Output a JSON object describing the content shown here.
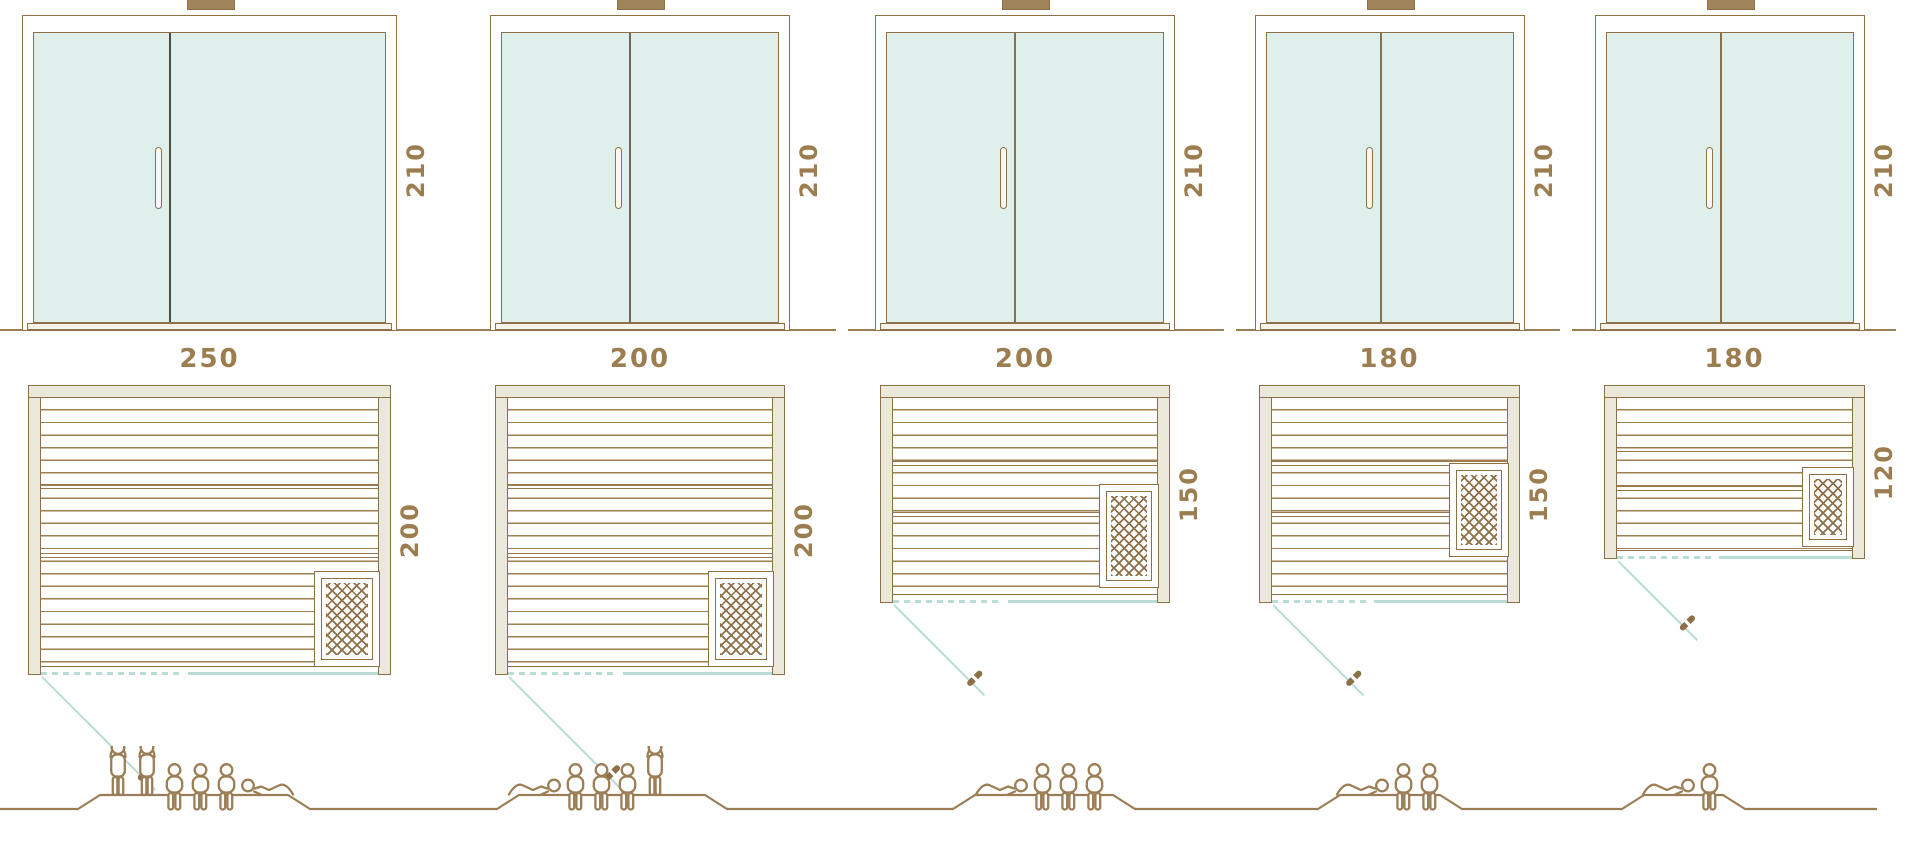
{
  "diagram": {
    "kind": "sauna-size-comparison",
    "rows": [
      "front-elevations",
      "floor-plans",
      "capacity-pictograms"
    ],
    "colors": {
      "line_brown": "#8e7048",
      "text_brown": "#9c7d50",
      "frame_beige": "#eae9d9",
      "glass_teal_fill": "#dff0ec",
      "teal_line": "#b9dcd6",
      "ground_brown": "#9a7d55",
      "background": "#ffffff"
    }
  },
  "units": [
    {
      "name": "sauna-250x200",
      "elevation": {
        "height_label": "210",
        "parts": [
          "glass-front",
          "door-divider",
          "door-handle",
          "top-cap",
          "base-sill"
        ]
      },
      "plan": {
        "width_label": "250",
        "depth_label": "200",
        "heater_position": "bottom-right",
        "door": "front-left, outward swing"
      },
      "capacity": {
        "standing": 2,
        "seated": 3,
        "lying": 1,
        "lying_position": "right",
        "total": 6
      }
    },
    {
      "name": "sauna-200x200",
      "elevation": {
        "height_label": "210",
        "parts": [
          "glass-front",
          "door-divider",
          "door-handle",
          "top-cap",
          "base-sill"
        ]
      },
      "plan": {
        "width_label": "200",
        "depth_label": "200",
        "heater_position": "bottom-right",
        "door": "front-left, outward swing"
      },
      "capacity": {
        "standing": 1,
        "seated": 3,
        "lying": 1,
        "lying_position": "left",
        "total": 5
      }
    },
    {
      "name": "sauna-200x150",
      "elevation": {
        "height_label": "210",
        "parts": [
          "glass-front",
          "door-divider",
          "door-handle",
          "top-cap",
          "base-sill"
        ]
      },
      "plan": {
        "width_label": "200",
        "depth_label": "150",
        "heater_position": "right",
        "door": "front-left, outward swing"
      },
      "capacity": {
        "standing": 0,
        "seated": 3,
        "lying": 1,
        "lying_position": "left",
        "total": 4
      }
    },
    {
      "name": "sauna-180x150",
      "elevation": {
        "height_label": "210",
        "parts": [
          "glass-front",
          "door-divider",
          "door-handle",
          "top-cap",
          "base-sill"
        ]
      },
      "plan": {
        "width_label": "180",
        "depth_label": "150",
        "heater_position": "right",
        "door": "front-left, outward swing"
      },
      "capacity": {
        "standing": 0,
        "seated": 2,
        "lying": 1,
        "lying_position": "left",
        "total": 3
      }
    },
    {
      "name": "sauna-180x120",
      "elevation": {
        "height_label": "210",
        "parts": [
          "glass-front",
          "door-divider",
          "door-handle",
          "top-cap",
          "base-sill"
        ]
      },
      "plan": {
        "width_label": "180",
        "depth_label": "120",
        "heater_position": "right",
        "door": "front-left, outward swing"
      },
      "capacity": {
        "standing": 0,
        "seated": 1,
        "lying": 1,
        "lying_position": "left",
        "total": 2
      }
    }
  ]
}
